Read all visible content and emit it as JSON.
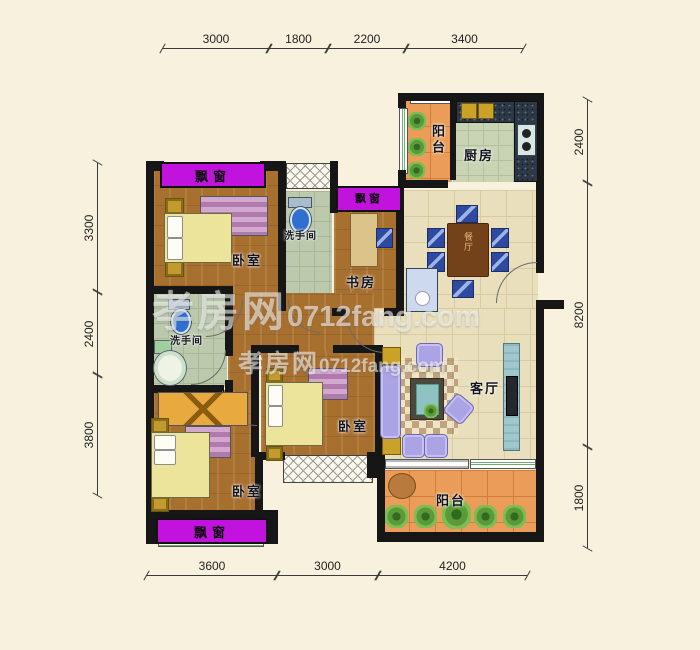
{
  "dimensions": {
    "top": [
      "3000",
      "1800",
      "2200",
      "3400"
    ],
    "left": [
      "3300",
      "2400",
      "3800"
    ],
    "right": [
      "2400",
      "8200",
      "1800"
    ],
    "bottom": [
      "3600",
      "3000",
      "4200"
    ]
  },
  "rooms": {
    "bay_top": "飘窗",
    "bay_study": "飘窗",
    "bay_bottom": "飘窗",
    "balcony_top": "阳台",
    "balcony_bottom": "阳台",
    "kitchen": "厨房",
    "bath_top": "洗手间",
    "bath_left": "洗手间",
    "study": "书房",
    "bedroom_top": "卧室",
    "bedroom_mid": "卧室",
    "bedroom_bottom": "卧室",
    "dining": "餐厅",
    "living": "客厅"
  },
  "watermark": {
    "brand": "孝房网",
    "site": "0712fang.com",
    "brand_small": "孝房网",
    "site_small": "0712fang.com"
  },
  "colors": {
    "background": "#f8f1de",
    "wall": "#161616",
    "bay_window": "#c212dd",
    "wood_floor": "#a8702f",
    "tile_floor": "#e9dfbd",
    "bath_tile": "#bcc9ad",
    "balcony_tile": "#ea9c58",
    "kitchen_floor": "#c9d4b4",
    "counter_mosaic": "#2e3947",
    "sofa": "#aaa3e4",
    "bed": "#ece49a",
    "dining_chair": "#2e4aa0"
  }
}
